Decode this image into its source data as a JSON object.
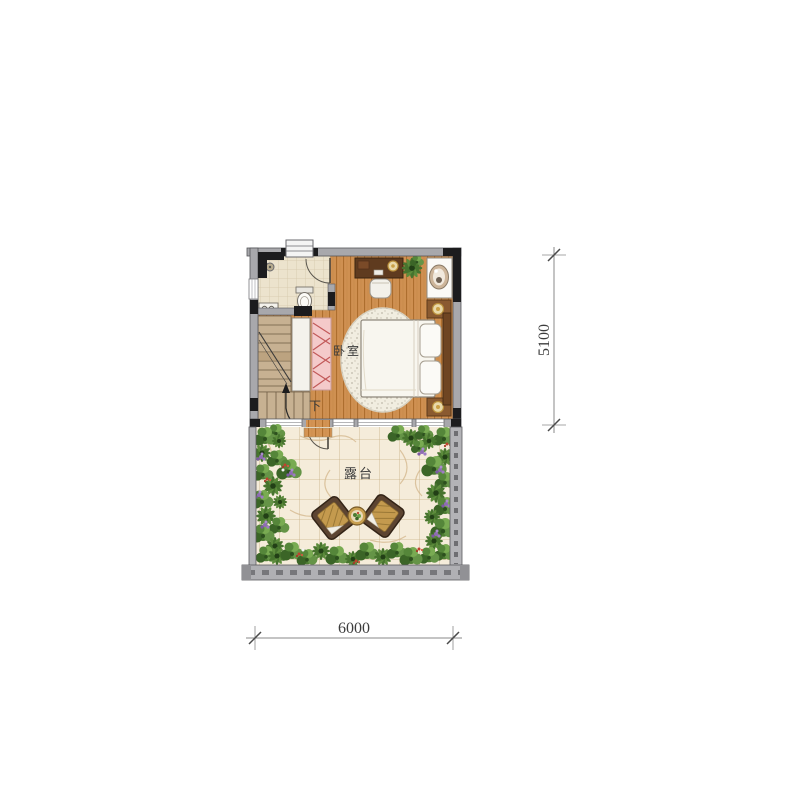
{
  "plan": {
    "bedroom": {
      "label": "卧室"
    },
    "terrace": {
      "label": "露台"
    },
    "stairs": {
      "label": "下"
    },
    "dimensions": {
      "vertical": "5100",
      "horizontal": "6000"
    },
    "palette": {
      "wall_gray": "#a8a8ac",
      "wall_black": "#1c1c1e",
      "wood_floor": "#d49454",
      "bathroom_tile": "#ece3cd",
      "wardrobe_pink": "#f4caca",
      "rug_cream": "#f1ede0",
      "bed_white": "#f8f6ef",
      "terrace_tile": "#f5ecda",
      "plant_green": "#4e7d33",
      "flower_purple": "#8f6cb4",
      "flower_red": "#c0432f",
      "dimension_line": "#8a8a8a"
    }
  }
}
